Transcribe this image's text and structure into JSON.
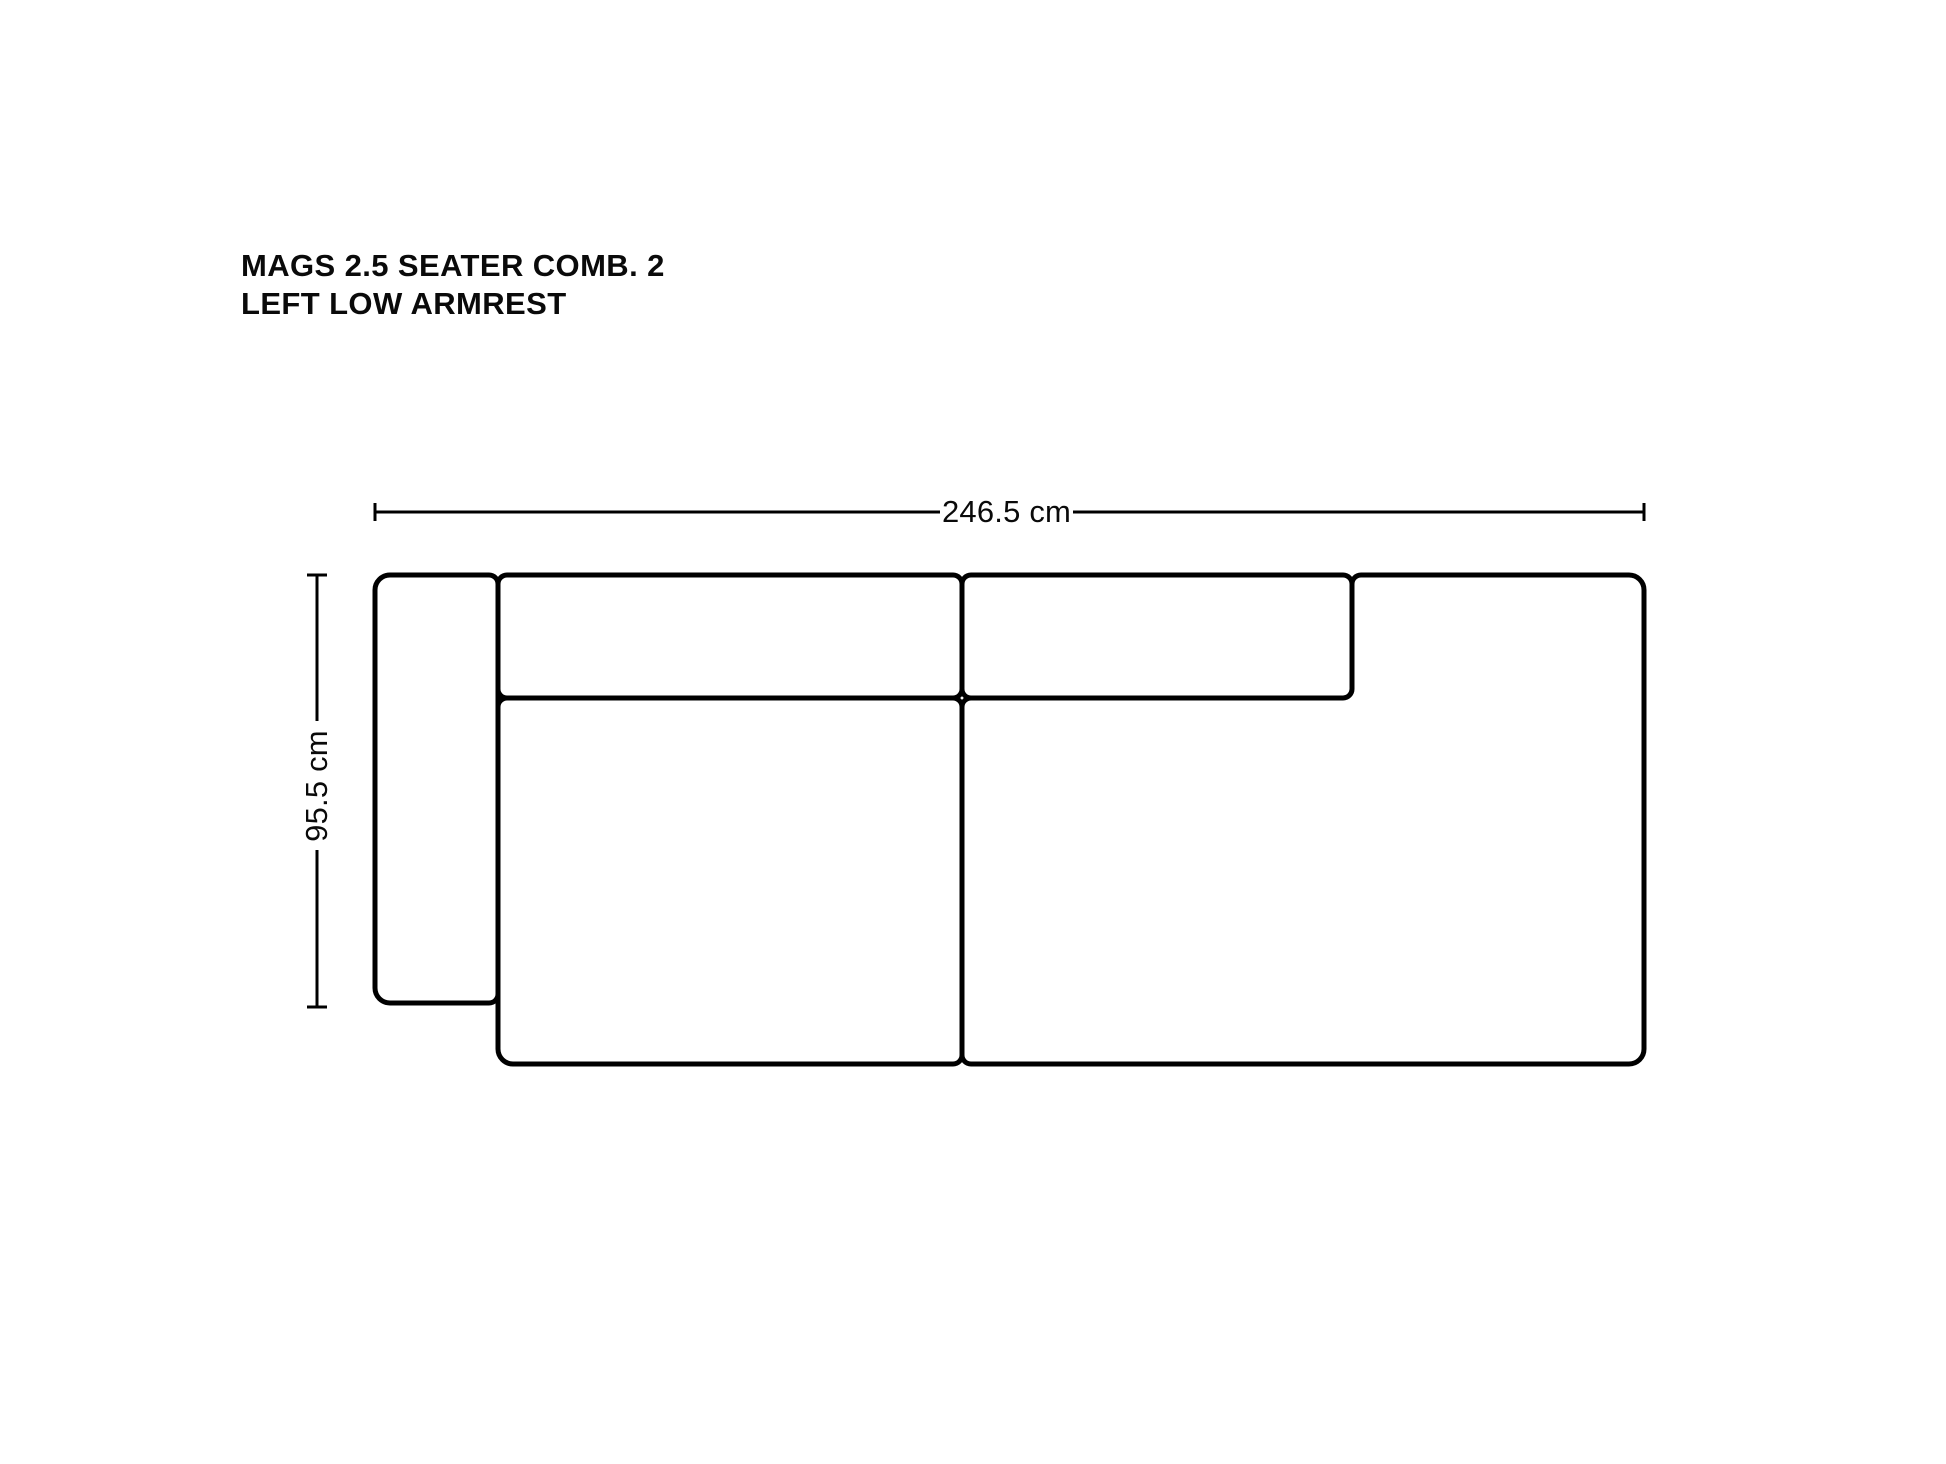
{
  "page": {
    "background_color": "#ffffff",
    "line_color": "#000000",
    "text_color": "#0a0a0a"
  },
  "title": {
    "line1": "MAGS 2.5 SEATER COMB. 2",
    "line2": "LEFT LOW ARMREST"
  },
  "diagram": {
    "type": "sofa-top-view-dimension-diagram",
    "width_dimension": {
      "label": "246.5 cm",
      "value_cm": 246.5
    },
    "depth_dimension": {
      "label": "95.5 cm",
      "value_cm": 95.5
    }
  }
}
